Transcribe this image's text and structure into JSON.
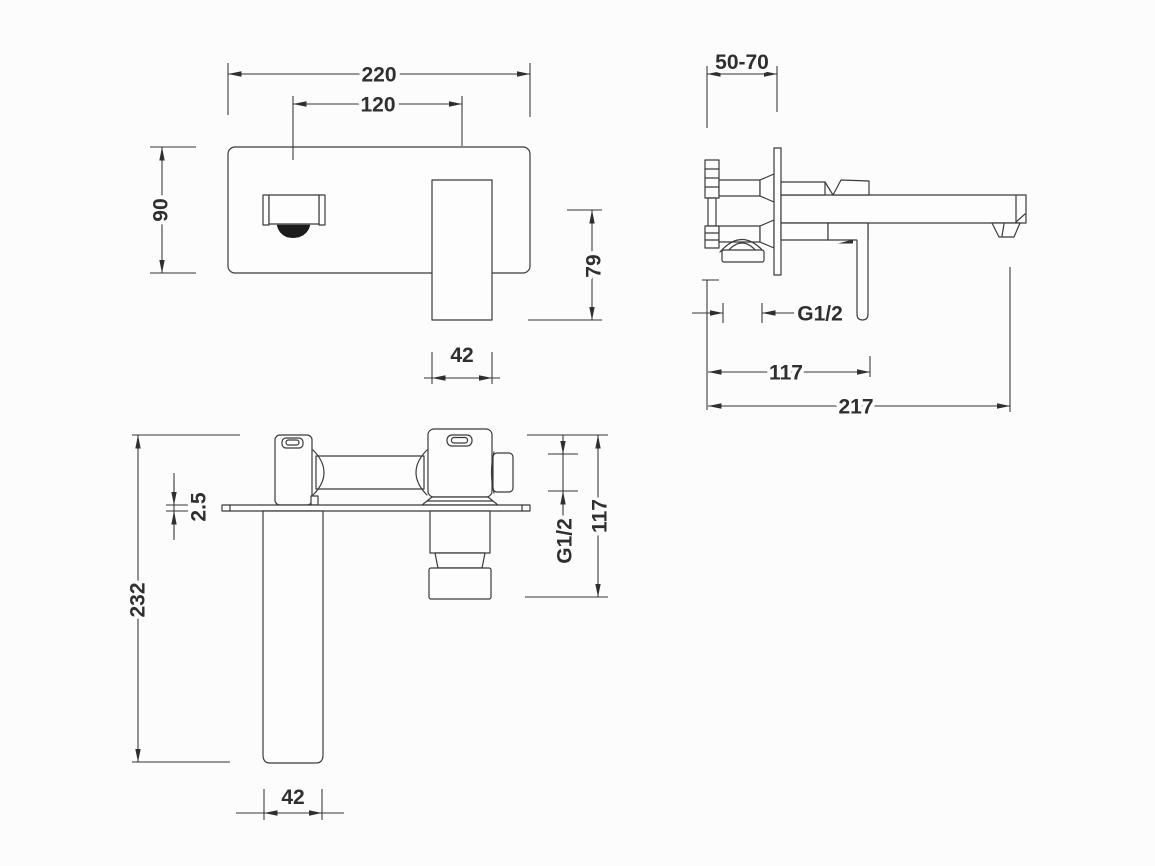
{
  "views": {
    "front": {
      "plate_width": "220",
      "spout_to_handle": "120",
      "plate_height": "90",
      "handle_drop": "79",
      "handle_width": "42"
    },
    "side": {
      "wall_depth_range": "50-70",
      "thread_size": "G1/2",
      "handle_distance": "117",
      "spout_reach": "217"
    },
    "top": {
      "plate_thickness": "2.5",
      "total_length": "232",
      "spout_width": "42",
      "thread_size": "G1/2",
      "body_length": "117"
    }
  },
  "colors": {
    "line": "#3b3b3b",
    "text": "#2f2f2f",
    "background": "#fcfcfc",
    "aerator": "#1c1c1c"
  }
}
